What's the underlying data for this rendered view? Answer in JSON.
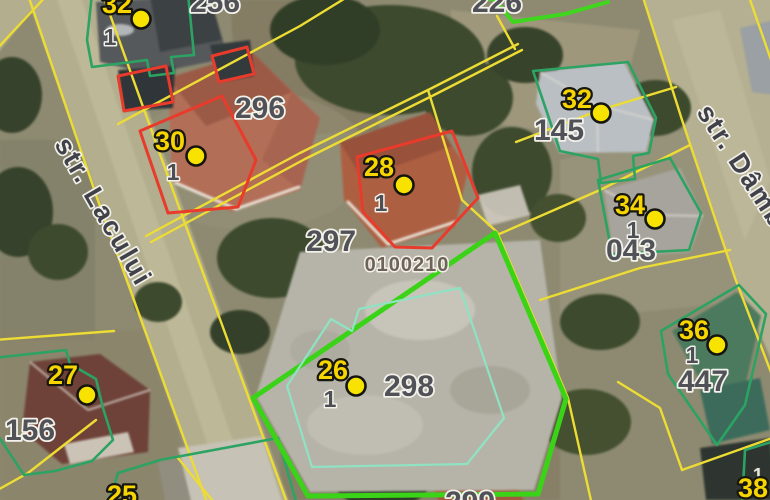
{
  "app": {
    "type": "cadastral-satellite-map"
  },
  "street_labels": {
    "left": "str. Lacului",
    "right": "str. Dâmb"
  },
  "cadastral_id": "0100210",
  "house_numbers": {
    "tl32": "32",
    "n30": "30",
    "n28": "28",
    "r32": "32",
    "n34": "34",
    "n36": "36",
    "n26": "26",
    "n27": "27",
    "n25": "25",
    "n38": "38"
  },
  "sub_numbers": {
    "tl32": "1",
    "n30": "1",
    "n28": "1",
    "n34": "1",
    "n36": "1",
    "n26": "1",
    "n38": "1"
  },
  "parcel_numbers": {
    "p256": "256",
    "p226": "226",
    "p296": "296",
    "p297": "297",
    "p298": "298",
    "p299": "299",
    "p145": "145",
    "p043": "043",
    "p447": "447",
    "p156": "156"
  },
  "colors": {
    "parcel_line_yellow": "#EDDC33",
    "building_outline_green": "#2CA263",
    "selected_parcel_green": "#3BD318",
    "highlight_red": "#E93B2C",
    "marker_yellow": "#F8E300",
    "house_label_yellow": "#F6D500",
    "parcel_label_gray": "#515158",
    "cadastral_label_brown": "#6E6358"
  }
}
